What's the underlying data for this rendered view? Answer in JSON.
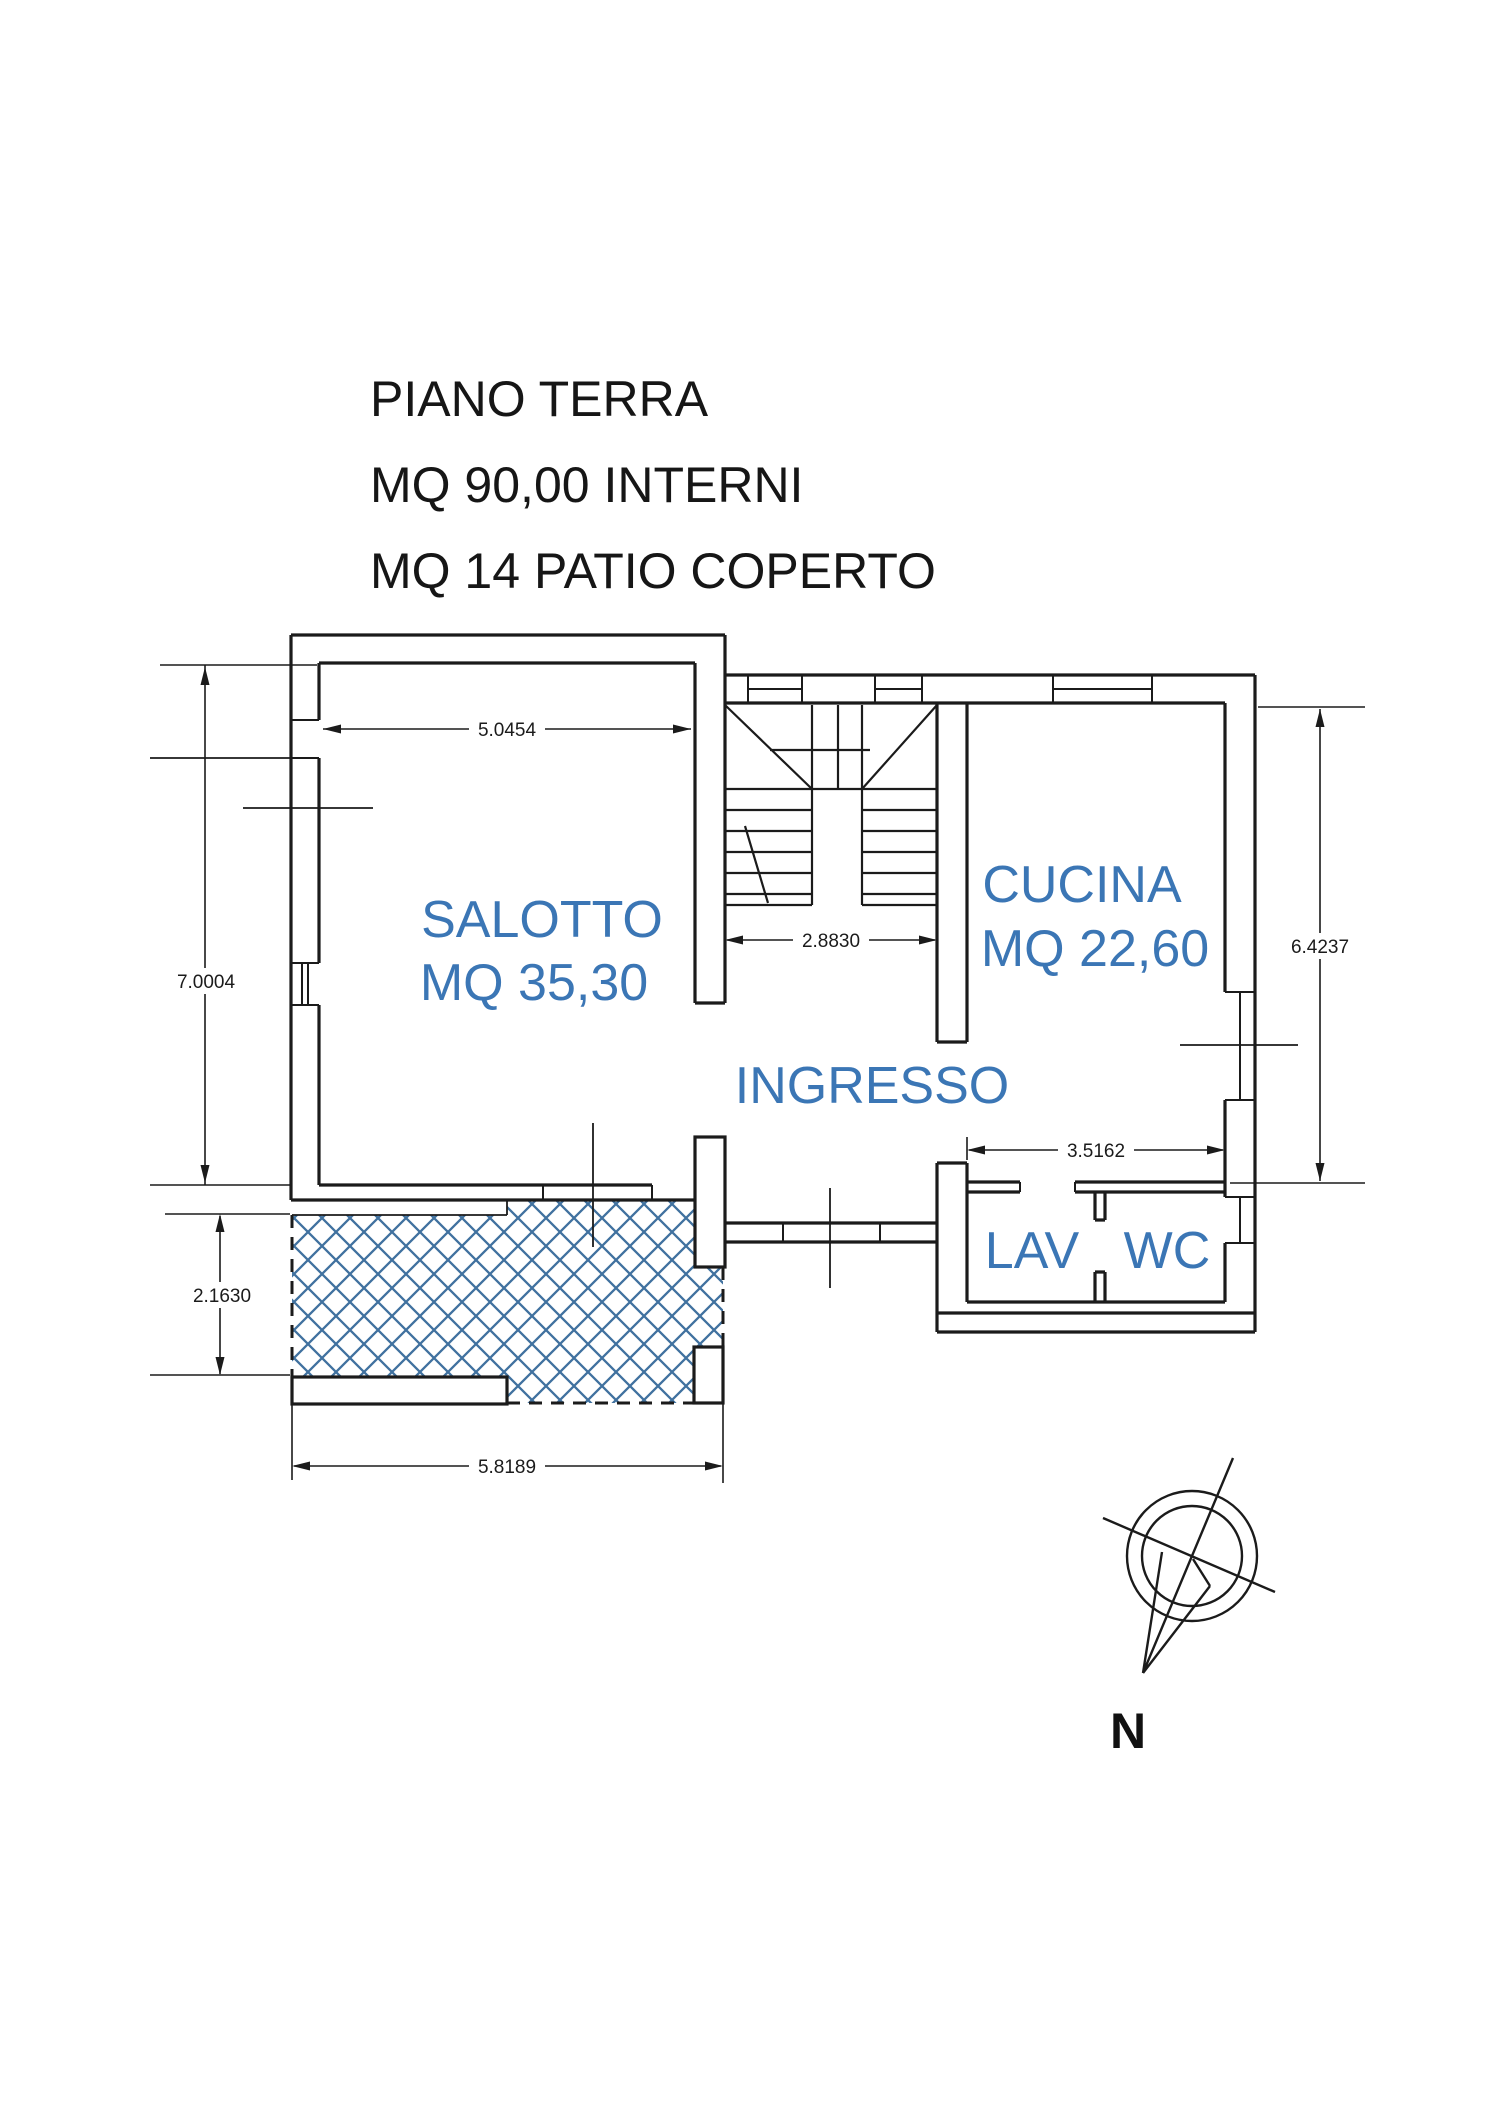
{
  "title": {
    "line1": "PIANO TERRA",
    "line2": "MQ 90,00 INTERNI",
    "line3": "MQ 14 PATIO COPERTO"
  },
  "rooms": {
    "salotto": {
      "name": "SALOTTO",
      "area": "MQ 35,30"
    },
    "cucina": {
      "name": "CUCINA",
      "area": "MQ 22,60"
    },
    "ingresso": {
      "name": "INGRESSO"
    },
    "lav": {
      "name": "LAV"
    },
    "wc": {
      "name": "WC"
    }
  },
  "dimensions": {
    "salotto_width": "5.0454",
    "left_height": "7.0004",
    "stair_width": "2.8830",
    "right_height": "6.4237",
    "lav_wc_width": "3.5162",
    "patio_height": "2.1630",
    "patio_width": "5.8189"
  },
  "compass": {
    "north_label": "N"
  },
  "colors": {
    "label_blue": "#3b76b5",
    "hatch_blue": "#40719f",
    "line_black": "#1b1b1b",
    "background": "#ffffff"
  }
}
